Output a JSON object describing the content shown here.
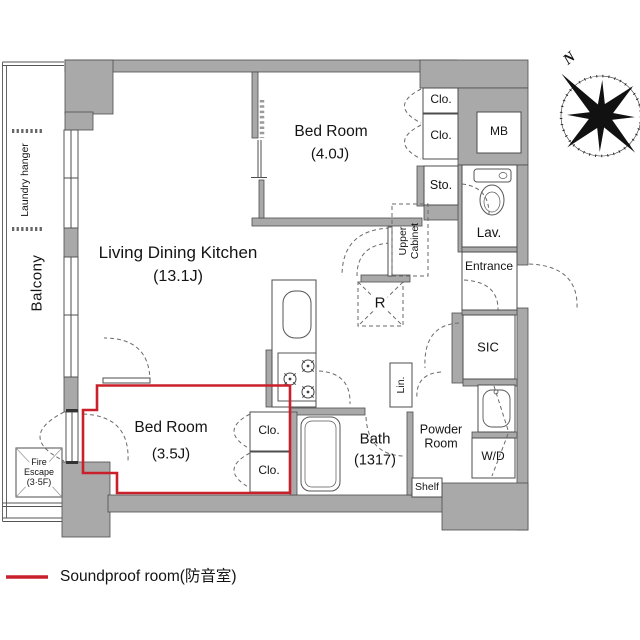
{
  "plan": {
    "rooms": {
      "living_dining_kitchen": {
        "name": "Living Dining Kitchen",
        "size": "(13.1J)"
      },
      "bedroom_4j": {
        "name": "Bed Room",
        "size": "(4.0J)"
      },
      "bedroom_soundproof": {
        "name": "Bed Room",
        "size": "(3.5J)"
      },
      "bath": {
        "name": "Bath",
        "size": "(1317)"
      },
      "powder_room": {
        "name": "Powder Room"
      },
      "lavatory": {
        "name": "Lav."
      },
      "entrance": {
        "name": "Entrance"
      },
      "shoe_closet": {
        "name": "SIC"
      },
      "balcony": {
        "name": "Balcony"
      }
    },
    "features": {
      "closet": "Clo.",
      "storage": "Sto.",
      "meter_box": "MB",
      "refrigerator": "R",
      "upper_cabinet": "Upper Cabinet",
      "linen": "Lin.",
      "shelf": "Shelf",
      "washer_dryer": "W/D",
      "laundry_hanger": "Laundry hanger",
      "fire_escape_line1": "Fire",
      "fire_escape_line2": "Escape",
      "fire_escape_line3": "(3·5F)"
    },
    "compass": {
      "north": "N"
    },
    "legend": {
      "soundproof": "Soundproof room(防音室)"
    },
    "colors": {
      "wall": "#a9a9a9",
      "soundproof_red": "#c9202b",
      "outline": "#4d4d4d"
    }
  }
}
